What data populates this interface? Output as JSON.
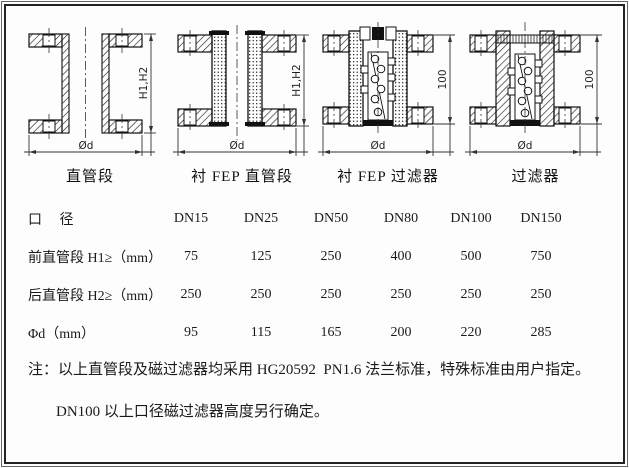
{
  "drawings": [
    {
      "caption": "直管段",
      "side_label": "H1,H2",
      "bottom_label": "Ød"
    },
    {
      "caption": "衬 FEP 直管段",
      "side_label": "H1,H2",
      "bottom_label": "Ød"
    },
    {
      "caption": "衬 FEP 过滤器",
      "side_label": "100",
      "bottom_label": "Ød"
    },
    {
      "caption": "过滤器",
      "side_label": "100",
      "bottom_label": "Ød"
    }
  ],
  "table": {
    "header_label": "口　 径",
    "columns": [
      "DN15",
      "DN25",
      "DN50",
      "DN80",
      "DN100",
      "DN150"
    ],
    "rows": [
      {
        "label": "前直管段 H1≥（mm）",
        "values": [
          "75",
          "125",
          "250",
          "400",
          "500",
          "750"
        ]
      },
      {
        "label": "后直管段 H2≥（mm）",
        "values": [
          "250",
          "250",
          "250",
          "250",
          "250",
          "250"
        ]
      },
      {
        "label": "Φd（mm）",
        "values": [
          "95",
          "115",
          "165",
          "200",
          "220",
          "285"
        ]
      }
    ]
  },
  "notes": [
    "注：以上直管段及磁过滤器均采用 HG20592  PN1.6 法兰标准，特殊标准由用户指定。",
    "DN100 以上口径磁过滤器高度另行确定。"
  ],
  "colors": {
    "line": "#222222",
    "background": "#fdfdfd"
  }
}
